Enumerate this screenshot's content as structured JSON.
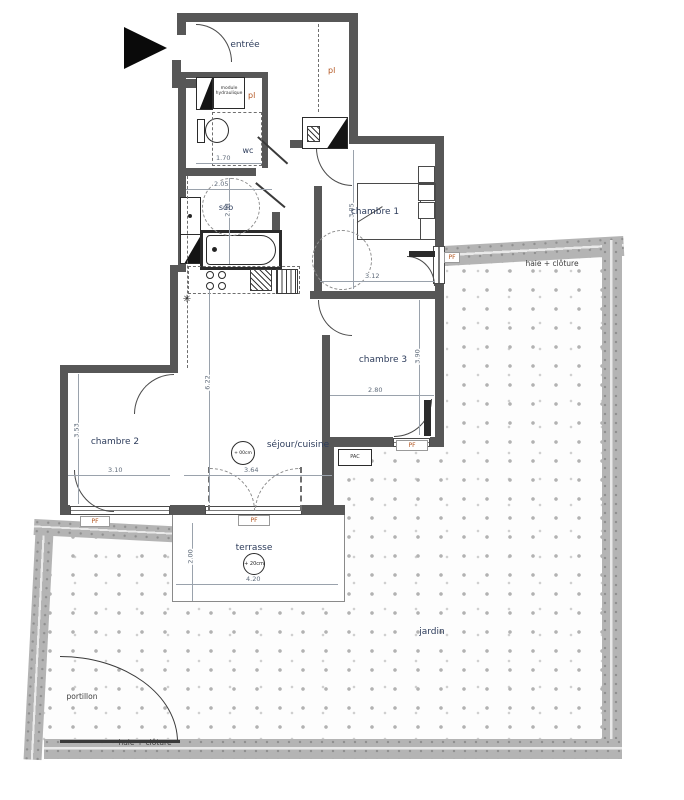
{
  "labels": {
    "entree": "entrée",
    "pl": "pl",
    "module_hydraulique": "module hydraulique",
    "wc": "wc",
    "sdb": "sdb",
    "chambre1": "chambre 1",
    "chambre2": "chambre 2",
    "chambre3": "chambre 3",
    "sejour_cuisine": "séjour/cuisine",
    "terrasse": "terrasse",
    "jardin": "jardin",
    "portillon": "portillon",
    "haie_cloture": "haie + clôture",
    "pf": "PF",
    "pac": "PAC"
  },
  "dimensions": {
    "wc_width": "1.70",
    "sdb_width": "2.05",
    "sdb_depth": "2.31",
    "chambre1_depth": "3.85",
    "chambre1_width": "3.12",
    "chambre3_depth": "3.90",
    "chambre3_width": "2.80",
    "chambre2_depth": "3.53",
    "chambre2_width": "3.10",
    "sejour_depth": "6.22",
    "sejour_width": "3.64",
    "terrasse_depth": "2.00",
    "terrasse_width": "4.20"
  },
  "level_markers": {
    "sejour": "+ 00cm",
    "terrasse": "+ 20cm"
  },
  "symbols": {
    "boiler": "✳"
  },
  "colors": {
    "wall": "#575757",
    "hedge_band": "#b4b4b4",
    "room_label": "#2e3d5c",
    "accent_label": "#b3551f",
    "dimension_label": "#5f6b7a"
  }
}
